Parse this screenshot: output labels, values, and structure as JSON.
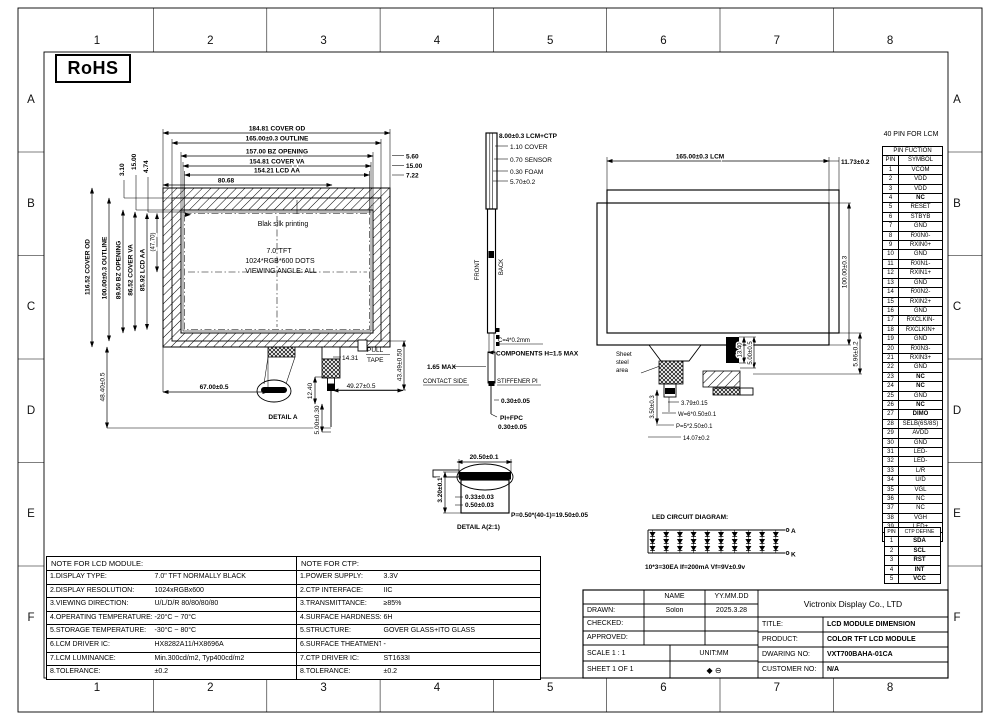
{
  "sheet": {
    "rohs": "RoHS",
    "cols": [
      "1",
      "2",
      "3",
      "4",
      "5",
      "6",
      "7",
      "8"
    ],
    "rows": [
      "A",
      "B",
      "C",
      "D",
      "E",
      "F"
    ]
  },
  "front_view": {
    "top_dims": [
      "184.81 COVER OD",
      "165.00±0.3 OUTLINE",
      "157.00 BZ OPENING",
      "154.81 COVER VA",
      "154.21 LCD AA"
    ],
    "dim_80": "80.68",
    "right_dims": [
      "5.60",
      "15.00",
      "7.22"
    ],
    "left_small_dims": [
      "3.10",
      "15.00",
      "4.74"
    ],
    "left_dims": [
      "116.52 COVER OD",
      "100.00±0.3 OUTLINE",
      "89.50 BZ OPENING",
      "86.52 COVER VA",
      "85.92 LCD AA"
    ],
    "left_ref": "(47.70)",
    "left_bottom_dim": "48.40±0.5",
    "silk": "Blak silk printing",
    "screen_line1": "7.0\"TFT",
    "screen_line2": "1024*RGB*600 DOTS",
    "screen_line3": "VIEWING ANGLE: ALL",
    "dim_67": "67.00±0.5",
    "dim_1431": "14.31",
    "pull_tape1": "PULL",
    "pull_tape2": "TAPE",
    "dim_4349": "43.49±0.50",
    "dim_1240": "12.40",
    "dim_4927": "49.27±0.5",
    "dim_500": "5.00±0.30",
    "detail_a": "DETAIL A"
  },
  "side_view": {
    "dim_total": "8.00±0.3 LCM+CTP",
    "dim_cover": "1.10 COVER",
    "dim_sensor": "0.70 SENSOR",
    "dim_foam": "0.30 FOAM",
    "dim_570": "5.70±0.2",
    "front": "FRONT",
    "back": "BACK",
    "comp_spec": "C=4*0.2mm",
    "components": "COMPONENTS H=1.5 MAX",
    "max_165": "1.65 MAX",
    "contact_side": "CONTACT SIDE",
    "stiffener": "STIFFENER PI",
    "dim_030a": "0.30±0.05",
    "pi_fpc": "PI+FPC",
    "dim_030b": "0.30±0.05"
  },
  "back_view": {
    "dim_lcm": "165.00±0.3 LCM",
    "dim_1173": "11.73±0.2",
    "dim_100": "100.00±0.3",
    "dim_596": "5.96±0.2",
    "sheet_steel_1": "Sheet",
    "sheet_steel_2": "steel",
    "sheet_steel_3": "area",
    "dim_1340": "13.40",
    "dim_500": "5.00±0.5",
    "dim_350": "3.50±0.3",
    "dim_379": "3.79±0.15",
    "dim_w": "W=6*0.50±0.1",
    "dim_p": "P=5*2.50±0.1",
    "dim_1407": "14.07±0.2"
  },
  "detail_a2": {
    "dim_2050": "20.50±0.1",
    "dim_320": "3.20±0.1",
    "dim_033": "0.33±0.03",
    "dim_050": "0.50±0.03",
    "pitch": "P=0.50*(40-1)=19.50±0.05",
    "title": "DETAIL A(2:1)"
  },
  "led": {
    "title": "LED CIRCUIT DIAGRAM:",
    "anode": "A",
    "cathode": "K",
    "note": "10*3=30EA If=200mA Vf=9V±0.9v",
    "rows": 3,
    "cols": 10
  },
  "lcm_pins": {
    "caption": "40 PIN FOR LCM",
    "header": "PIN FUCTION",
    "col_pin": "PIN",
    "col_symbol": "SYMBOL",
    "rows": [
      {
        "pin": "1",
        "symbol": "VCOM"
      },
      {
        "pin": "2",
        "symbol": "VDD"
      },
      {
        "pin": "3",
        "symbol": "VDD"
      },
      {
        "pin": "4",
        "symbol": "NC",
        "bold": true
      },
      {
        "pin": "5",
        "symbol": "RESET"
      },
      {
        "pin": "6",
        "symbol": "STBYB"
      },
      {
        "pin": "7",
        "symbol": "GND"
      },
      {
        "pin": "8",
        "symbol": "RXIN0-"
      },
      {
        "pin": "9",
        "symbol": "RXIN0+"
      },
      {
        "pin": "10",
        "symbol": "GND"
      },
      {
        "pin": "11",
        "symbol": "RXIN1-"
      },
      {
        "pin": "12",
        "symbol": "RXIN1+"
      },
      {
        "pin": "13",
        "symbol": "GND"
      },
      {
        "pin": "14",
        "symbol": "RXIN2-"
      },
      {
        "pin": "15",
        "symbol": "RXIN2+"
      },
      {
        "pin": "16",
        "symbol": "GND"
      },
      {
        "pin": "17",
        "symbol": "RXCLKIN-"
      },
      {
        "pin": "18",
        "symbol": "RXCLKIN+"
      },
      {
        "pin": "19",
        "symbol": "GND"
      },
      {
        "pin": "20",
        "symbol": "RXIN3-"
      },
      {
        "pin": "21",
        "symbol": "RXIN3+"
      },
      {
        "pin": "22",
        "symbol": "GND"
      },
      {
        "pin": "23",
        "symbol": "NC",
        "bold": true
      },
      {
        "pin": "24",
        "symbol": "NC",
        "bold": true
      },
      {
        "pin": "25",
        "symbol": "GND"
      },
      {
        "pin": "26",
        "symbol": "NC",
        "bold": true
      },
      {
        "pin": "27",
        "symbol": "DIMO",
        "bold": true
      },
      {
        "pin": "28",
        "symbol": "SELB(6S/8S)"
      },
      {
        "pin": "29",
        "symbol": "AVDD"
      },
      {
        "pin": "30",
        "symbol": "GND"
      },
      {
        "pin": "31",
        "symbol": "LED-"
      },
      {
        "pin": "32",
        "symbol": "LED-"
      },
      {
        "pin": "33",
        "symbol": "L/R"
      },
      {
        "pin": "34",
        "symbol": "U/D"
      },
      {
        "pin": "35",
        "symbol": "VGL"
      },
      {
        "pin": "36",
        "symbol": "NC"
      },
      {
        "pin": "37",
        "symbol": "NC"
      },
      {
        "pin": "38",
        "symbol": "VGH"
      },
      {
        "pin": "39",
        "symbol": "LED+"
      },
      {
        "pin": "40",
        "symbol": "LED+"
      }
    ]
  },
  "ctp_pins": {
    "col_pin": "PIN",
    "col_define": "CTP DEFINE",
    "rows": [
      {
        "pin": "1",
        "symbol": "SDA",
        "bold": true
      },
      {
        "pin": "2",
        "symbol": "SCL",
        "bold": true
      },
      {
        "pin": "3",
        "symbol": "RST",
        "bold": true
      },
      {
        "pin": "4",
        "symbol": "INT",
        "bold": true
      },
      {
        "pin": "5",
        "symbol": "VCC",
        "bold": true
      }
    ]
  },
  "lcd_notes": {
    "title": "NOTE FOR LCD MODULE:",
    "rows": [
      {
        "label": "1.DISPLAY TYPE:",
        "value": "7.0\" TFT NORMALLY BLACK"
      },
      {
        "label": "2.DISPLAY RESOLUTION:",
        "value": "1024xRGBx600"
      },
      {
        "label": "3.VIEWING DIRECTION:",
        "value": "U/L/D/R 80/80/80/80"
      },
      {
        "label": "4.OPERATING TEMPERATURE:",
        "value": "-20°C ~ 70°C"
      },
      {
        "label": "5.STORAGE TEMPERATURE:",
        "value": "-30°C ~ 80°C"
      },
      {
        "label": "6.LCM DRIVER IC:",
        "value": "HX8282A11/HX8696A"
      },
      {
        "label": "7.LCM LUMINANCE:",
        "value": "Min.300cd/m2, Typ400cd/m2"
      },
      {
        "label": "8.TOLERANCE:",
        "value": "±0.2"
      }
    ]
  },
  "ctp_notes": {
    "title": "NOTE FOR CTP:",
    "rows": [
      {
        "label": "1.POWER SUPPLY:",
        "value": "3.3V"
      },
      {
        "label": "2.CTP INTERFACE:",
        "value": "IIC"
      },
      {
        "label": "3.TRANSMITTANCE:",
        "value": "≥85%"
      },
      {
        "label": "4.SURFACE HARDNESS:",
        "value": "6H"
      },
      {
        "label": "5.STRUCTURE:",
        "value": "GOVER GLASS+ITO GLASS"
      },
      {
        "label": "6.SURFACE THEATMENT:",
        "value": "-"
      },
      {
        "label": "7.CTP DRIVER IC:",
        "value": "ST1633I"
      },
      {
        "label": "8.TOLERANCE:",
        "value": "±0.2"
      }
    ]
  },
  "title_block": {
    "company": "Victronix Display Co., LTD",
    "name_header": "NAME",
    "date_header": "YY.MM.DD",
    "drawn_label": "DRAWN:",
    "drawn_name": "Solon",
    "drawn_date": "2025.3.28",
    "checked_label": "CHECKED:",
    "approved_label": "APPROVED:",
    "scale": "SCALE 1 : 1",
    "unit": "UNIT:MM",
    "sheet": "SHEET 1 OF 1",
    "projection": "◆ ⊖",
    "title_label": "TITLE:",
    "title_value": "LCD MODULE DIMENSION",
    "product_label": "PRODUCT:",
    "product_value": "COLOR TFT LCD MODULE",
    "drawing_label": "DWARING NO:",
    "drawing_value": "VXT700BAHA-01CA",
    "customer_label": "CUSTOMER NO:",
    "customer_value": "N/A"
  }
}
